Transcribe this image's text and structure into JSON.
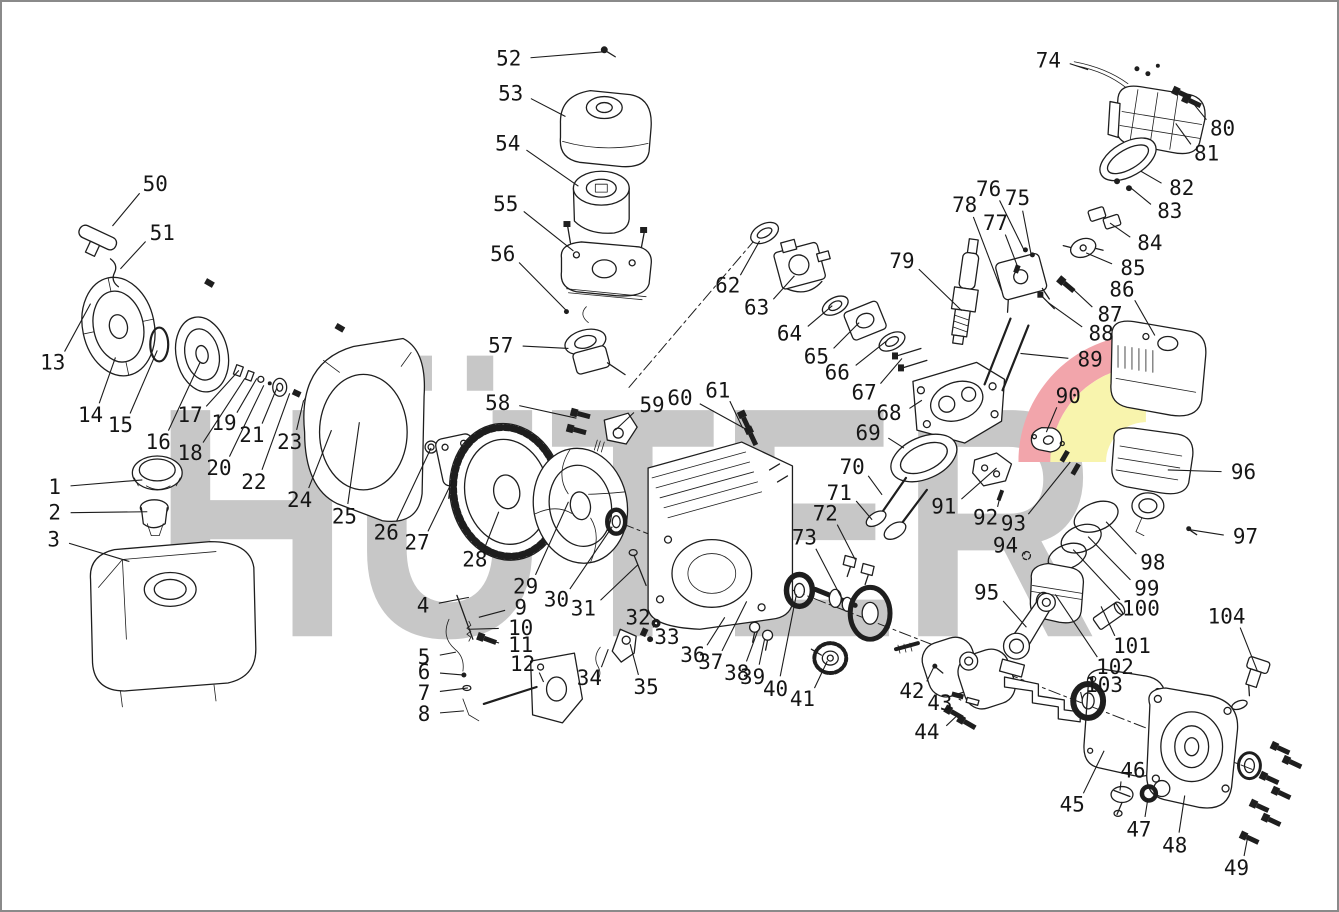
{
  "watermark": {
    "text": "HÜTER",
    "color": "#c7c7c7",
    "swoosh_red": "#f2a5ab",
    "swoosh_yellow": "#f8f4ad"
  },
  "callouts": [
    {
      "n": "1",
      "x": 52,
      "y": 487,
      "tx": 140,
      "ty": 480
    },
    {
      "n": "2",
      "x": 52,
      "y": 513,
      "tx": 145,
      "ty": 512
    },
    {
      "n": "3",
      "x": 51,
      "y": 540,
      "tx": 127,
      "ty": 562
    },
    {
      "n": "4",
      "x": 422,
      "y": 606,
      "tx": 468,
      "ty": 598
    },
    {
      "n": "5",
      "x": 423,
      "y": 658,
      "tx": 455,
      "ty": 653
    },
    {
      "n": "6",
      "x": 423,
      "y": 673,
      "tx": 463,
      "ty": 676
    },
    {
      "n": "7",
      "x": 423,
      "y": 694,
      "tx": 467,
      "ty": 689
    },
    {
      "n": "8",
      "x": 423,
      "y": 715,
      "tx": 463,
      "ty": 712
    },
    {
      "n": "9",
      "x": 520,
      "y": 608,
      "tx": 478,
      "ty": 618
    },
    {
      "n": "10",
      "x": 520,
      "y": 629,
      "tx": 468,
      "ty": 630
    },
    {
      "n": "11",
      "x": 520,
      "y": 646,
      "tx": 485,
      "ty": 640
    },
    {
      "n": "12",
      "x": 522,
      "y": 665,
      "tx": 543,
      "ty": 683
    },
    {
      "n": "13",
      "x": 50,
      "y": 362,
      "tx": 88,
      "ty": 303
    },
    {
      "n": "14",
      "x": 88,
      "y": 415,
      "tx": 113,
      "ty": 357
    },
    {
      "n": "15",
      "x": 118,
      "y": 425,
      "tx": 155,
      "ty": 350
    },
    {
      "n": "16",
      "x": 156,
      "y": 442,
      "tx": 198,
      "ty": 362
    },
    {
      "n": "17",
      "x": 188,
      "y": 415,
      "tx": 237,
      "ty": 370
    },
    {
      "n": "18",
      "x": 188,
      "y": 453,
      "tx": 243,
      "ty": 378
    },
    {
      "n": "19",
      "x": 222,
      "y": 423,
      "tx": 255,
      "ty": 378
    },
    {
      "n": "20",
      "x": 217,
      "y": 468,
      "tx": 262,
      "ty": 385
    },
    {
      "n": "21",
      "x": 250,
      "y": 435,
      "tx": 275,
      "ty": 388
    },
    {
      "n": "22",
      "x": 252,
      "y": 482,
      "tx": 288,
      "ty": 393
    },
    {
      "n": "23",
      "x": 288,
      "y": 442,
      "tx": 302,
      "ty": 400
    },
    {
      "n": "24",
      "x": 298,
      "y": 500,
      "tx": 330,
      "ty": 430
    },
    {
      "n": "25",
      "x": 343,
      "y": 517,
      "tx": 358,
      "ty": 422
    },
    {
      "n": "26",
      "x": 385,
      "y": 533,
      "tx": 430,
      "ty": 448
    },
    {
      "n": "27",
      "x": 416,
      "y": 543,
      "tx": 452,
      "ty": 480
    },
    {
      "n": "28",
      "x": 474,
      "y": 560,
      "tx": 498,
      "ty": 512
    },
    {
      "n": "29",
      "x": 525,
      "y": 587,
      "tx": 568,
      "ty": 502
    },
    {
      "n": "30",
      "x": 556,
      "y": 600,
      "tx": 612,
      "ty": 527
    },
    {
      "n": "31",
      "x": 583,
      "y": 609,
      "tx": 638,
      "ty": 565
    },
    {
      "n": "32",
      "x": 638,
      "y": 618,
      "tx": 644,
      "ty": 634
    },
    {
      "n": "33",
      "x": 667,
      "y": 638,
      "tx": 656,
      "ty": 625
    },
    {
      "n": "34",
      "x": 589,
      "y": 679,
      "tx": 608,
      "ty": 650
    },
    {
      "n": "35",
      "x": 646,
      "y": 688,
      "tx": 630,
      "ty": 645
    },
    {
      "n": "36",
      "x": 693,
      "y": 656,
      "tx": 725,
      "ty": 618
    },
    {
      "n": "37",
      "x": 711,
      "y": 663,
      "tx": 747,
      "ty": 602
    },
    {
      "n": "38",
      "x": 737,
      "y": 674,
      "tx": 758,
      "ty": 632
    },
    {
      "n": "39",
      "x": 753,
      "y": 678,
      "tx": 765,
      "ty": 640
    },
    {
      "n": "40",
      "x": 776,
      "y": 690,
      "tx": 797,
      "ty": 595
    },
    {
      "n": "41",
      "x": 803,
      "y": 700,
      "tx": 828,
      "ty": 662
    },
    {
      "n": "42",
      "x": 913,
      "y": 692,
      "tx": 935,
      "ty": 668
    },
    {
      "n": "43",
      "x": 941,
      "y": 704,
      "tx": 960,
      "ty": 700
    },
    {
      "n": "44",
      "x": 928,
      "y": 733,
      "tx": 957,
      "ty": 718
    },
    {
      "n": "45",
      "x": 1074,
      "y": 806,
      "tx": 1106,
      "ty": 752
    },
    {
      "n": "46",
      "x": 1135,
      "y": 772,
      "tx": 1122,
      "ty": 792
    },
    {
      "n": "47",
      "x": 1141,
      "y": 831,
      "tx": 1150,
      "ty": 800
    },
    {
      "n": "48",
      "x": 1177,
      "y": 847,
      "tx": 1187,
      "ty": 797
    },
    {
      "n": "49",
      "x": 1239,
      "y": 870,
      "tx": 1250,
      "ty": 840
    },
    {
      "n": "50",
      "x": 153,
      "y": 183,
      "tx": 110,
      "ty": 225
    },
    {
      "n": "51",
      "x": 160,
      "y": 232,
      "tx": 118,
      "ty": 268
    },
    {
      "n": "52",
      "x": 508,
      "y": 57,
      "tx": 603,
      "ty": 50
    },
    {
      "n": "53",
      "x": 510,
      "y": 92,
      "tx": 565,
      "ty": 115
    },
    {
      "n": "54",
      "x": 507,
      "y": 142,
      "tx": 578,
      "ty": 185
    },
    {
      "n": "55",
      "x": 505,
      "y": 203,
      "tx": 573,
      "ty": 250
    },
    {
      "n": "56",
      "x": 502,
      "y": 253,
      "tx": 566,
      "ty": 310
    },
    {
      "n": "57",
      "x": 500,
      "y": 345,
      "tx": 568,
      "ty": 348
    },
    {
      "n": "58",
      "x": 497,
      "y": 403,
      "tx": 576,
      "ty": 418
    },
    {
      "n": "59",
      "x": 652,
      "y": 405,
      "tx": 615,
      "ty": 430
    },
    {
      "n": "60",
      "x": 680,
      "y": 398,
      "tx": 748,
      "ty": 430
    },
    {
      "n": "61",
      "x": 718,
      "y": 390,
      "tx": 743,
      "ty": 428
    },
    {
      "n": "62",
      "x": 728,
      "y": 285,
      "tx": 760,
      "ty": 240
    },
    {
      "n": "63",
      "x": 757,
      "y": 307,
      "tx": 795,
      "ty": 275
    },
    {
      "n": "64",
      "x": 790,
      "y": 333,
      "tx": 833,
      "ty": 305
    },
    {
      "n": "65",
      "x": 817,
      "y": 356,
      "tx": 860,
      "ty": 322
    },
    {
      "n": "66",
      "x": 838,
      "y": 372,
      "tx": 888,
      "ty": 340
    },
    {
      "n": "67",
      "x": 865,
      "y": 392,
      "tx": 903,
      "ty": 358
    },
    {
      "n": "68",
      "x": 890,
      "y": 413,
      "tx": 923,
      "ty": 400
    },
    {
      "n": "69",
      "x": 869,
      "y": 433,
      "tx": 905,
      "ty": 448
    },
    {
      "n": "70",
      "x": 853,
      "y": 467,
      "tx": 883,
      "ty": 495
    },
    {
      "n": "71",
      "x": 840,
      "y": 493,
      "tx": 873,
      "ty": 520
    },
    {
      "n": "72",
      "x": 826,
      "y": 514,
      "tx": 856,
      "ty": 560
    },
    {
      "n": "73",
      "x": 805,
      "y": 538,
      "tx": 843,
      "ty": 600
    },
    {
      "n": "74",
      "x": 1050,
      "y": 59,
      "tx": 1090,
      "ty": 68
    },
    {
      "n": "75",
      "x": 1019,
      "y": 197,
      "tx": 1033,
      "ty": 255
    },
    {
      "n": "76",
      "x": 990,
      "y": 188,
      "tx": 1026,
      "ty": 250
    },
    {
      "n": "77",
      "x": 997,
      "y": 222,
      "tx": 1020,
      "ty": 268
    },
    {
      "n": "78",
      "x": 966,
      "y": 204,
      "tx": 1003,
      "ty": 290
    },
    {
      "n": "79",
      "x": 903,
      "y": 260,
      "tx": 963,
      "ty": 310
    },
    {
      "n": "80",
      "x": 1225,
      "y": 127,
      "tx": 1190,
      "ty": 95
    },
    {
      "n": "81",
      "x": 1209,
      "y": 152,
      "tx": 1178,
      "ty": 122
    },
    {
      "n": "82",
      "x": 1184,
      "y": 187,
      "tx": 1143,
      "ty": 170
    },
    {
      "n": "83",
      "x": 1172,
      "y": 210,
      "tx": 1132,
      "ty": 186
    },
    {
      "n": "84",
      "x": 1152,
      "y": 242,
      "tx": 1112,
      "ty": 222
    },
    {
      "n": "85",
      "x": 1135,
      "y": 267,
      "tx": 1088,
      "ty": 252
    },
    {
      "n": "86",
      "x": 1124,
      "y": 289,
      "tx": 1157,
      "ty": 335
    },
    {
      "n": "87",
      "x": 1112,
      "y": 314,
      "tx": 1068,
      "ty": 282
    },
    {
      "n": "88",
      "x": 1103,
      "y": 333,
      "tx": 1050,
      "ty": 302
    },
    {
      "n": "89",
      "x": 1092,
      "y": 359,
      "tx": 1022,
      "ty": 353
    },
    {
      "n": "90",
      "x": 1070,
      "y": 396,
      "tx": 1048,
      "ty": 432
    },
    {
      "n": "91",
      "x": 945,
      "y": 507,
      "tx": 998,
      "ty": 468
    },
    {
      "n": "92",
      "x": 987,
      "y": 518,
      "tx": 1002,
      "ty": 495
    },
    {
      "n": "93",
      "x": 1015,
      "y": 524,
      "tx": 1072,
      "ty": 462
    },
    {
      "n": "94",
      "x": 1007,
      "y": 546,
      "tx": 1026,
      "ty": 555
    },
    {
      "n": "95",
      "x": 988,
      "y": 593,
      "tx": 1028,
      "ty": 628
    },
    {
      "n": "96",
      "x": 1246,
      "y": 472,
      "tx": 1170,
      "ty": 470
    },
    {
      "n": "97",
      "x": 1248,
      "y": 537,
      "tx": 1192,
      "ty": 530
    },
    {
      "n": "98",
      "x": 1155,
      "y": 563,
      "tx": 1108,
      "ty": 522
    },
    {
      "n": "99",
      "x": 1149,
      "y": 589,
      "tx": 1090,
      "ty": 537
    },
    {
      "n": "100",
      "x": 1143,
      "y": 609,
      "tx": 1075,
      "ty": 550
    },
    {
      "n": "101",
      "x": 1134,
      "y": 647,
      "tx": 1103,
      "ty": 607
    },
    {
      "n": "102",
      "x": 1117,
      "y": 668,
      "tx": 1057,
      "ty": 595
    },
    {
      "n": "103",
      "x": 1106,
      "y": 686,
      "tx": 1084,
      "ty": 700
    },
    {
      "n": "104",
      "x": 1229,
      "y": 617,
      "tx": 1260,
      "ty": 672
    }
  ]
}
